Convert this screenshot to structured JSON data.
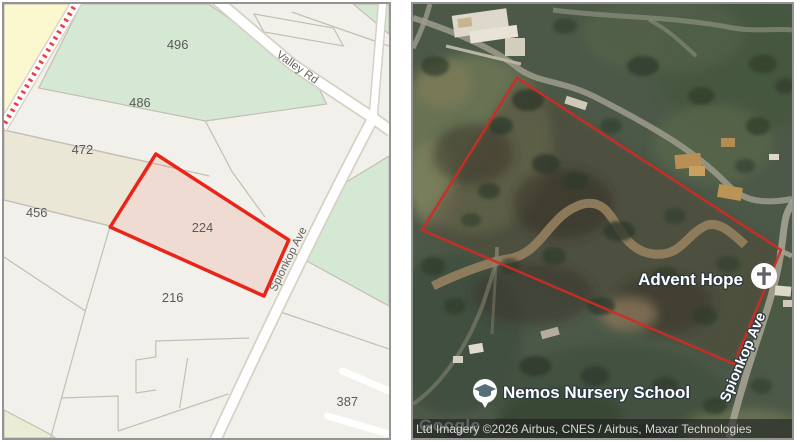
{
  "left_map": {
    "description": "Cadastral parcel map with highlighted erf",
    "parcel_labels": {
      "p496": "496",
      "p486": "486",
      "p472": "472",
      "p456": "456",
      "p224": "224",
      "p216": "216",
      "p387": "387"
    },
    "road_labels": {
      "valley": "Valley Rd",
      "spionkop": "Spionkop Ave"
    },
    "highlight": {
      "parcel": "224",
      "outline_color": "#ea2419",
      "fill_color": "#f9e2e0"
    },
    "colors": {
      "base": "#f2f0ea",
      "green_parcel": "#d5e8d3",
      "beige_parcel": "#eae7d6",
      "yellow_parcel": "#fbf8d0",
      "boundary": "#c3bfb4",
      "road_fill": "#ffffff",
      "road_casing": "#d5d1c6",
      "dashed_strip": "#ee4040"
    }
  },
  "right_map": {
    "description": "Satellite imagery with red parcel outline",
    "poi": [
      {
        "name": "Advent Hope",
        "icon": "church-cross"
      },
      {
        "name": "Nemos Nursery School",
        "icon": "graduation-cap"
      }
    ],
    "road_label": "Spionkop Ave",
    "watermark": "Google",
    "attribution": "Ltd Imagery ©2026 Airbus, CNES / Airbus, Maxar Technologies",
    "outline_color": "#cf2b25"
  }
}
